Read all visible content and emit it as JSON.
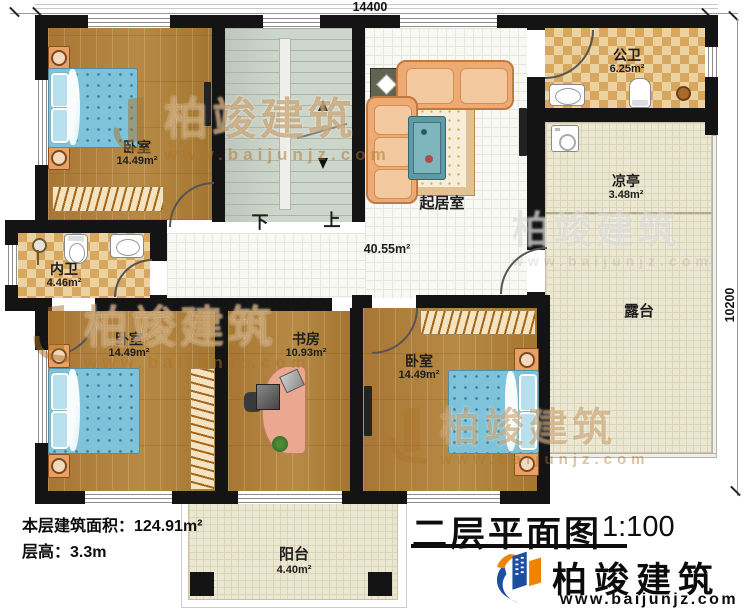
{
  "dimensions": {
    "top_width": "14400",
    "right_height": "10200"
  },
  "rooms": {
    "bedroom_tl": {
      "name": "卧室",
      "area": "14.49m²"
    },
    "inner_bathroom": {
      "name": "内卫",
      "area": "4.46m²"
    },
    "public_bathroom": {
      "name": "公卫",
      "area": "6.25m²"
    },
    "pavilion": {
      "name": "凉亭",
      "area": "3.48m²"
    },
    "living_room": {
      "name": "起居室",
      "area": "40.55m²"
    },
    "terrace": {
      "name": "露台"
    },
    "bedroom_bl": {
      "name": "卧室",
      "area": "14.49m²"
    },
    "study": {
      "name": "书房",
      "area": "10.93m²"
    },
    "bedroom_br": {
      "name": "卧室",
      "area": "14.49m²"
    },
    "balcony": {
      "name": "阳台",
      "area": "4.40m²"
    }
  },
  "stairs": {
    "down_label": "下",
    "up_label": "上"
  },
  "floor_info": {
    "building_area": "本层建筑面积：124.91m²",
    "floor_height": "层高：3.3m"
  },
  "title_block": {
    "title": "二层平面图",
    "scale": "1:100"
  },
  "brand": {
    "name": "柏竣建筑",
    "website": "www.baijunjz.com"
  },
  "watermark": {
    "name": "柏竣建筑",
    "website": "www.baijunjz.com"
  },
  "colors": {
    "wall": "#141414",
    "wood_floor": "#a87d3d",
    "white_tile": "#f8f8f4",
    "cream_tile": "#ece7d2",
    "checker_light": "#ecd2a0",
    "checker_dark": "#d8a75f",
    "stair": "#cdd6ca",
    "bed_blue": "#7fc3da",
    "sofa_orange": "#edaa72",
    "logo_blue": "#1c4f9e",
    "logo_orange": "#f08300"
  }
}
